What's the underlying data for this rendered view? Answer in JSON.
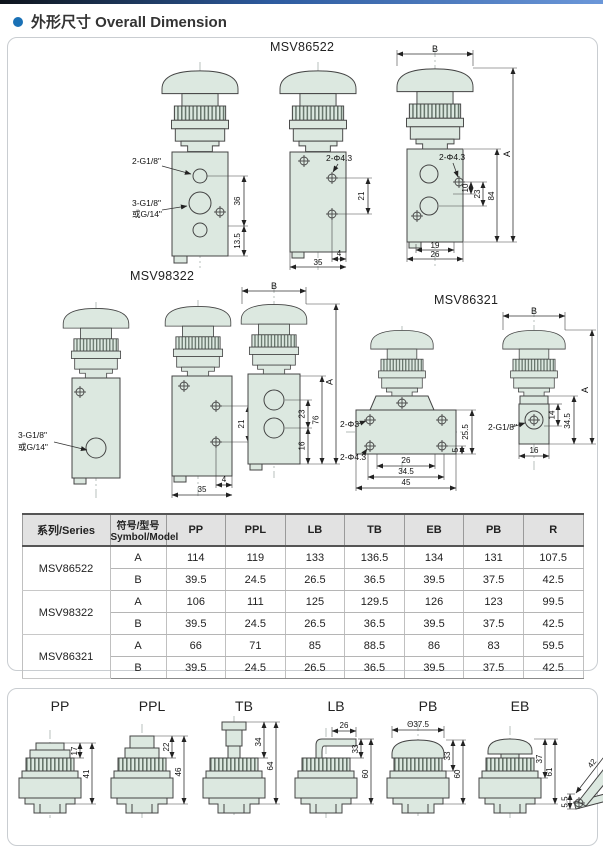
{
  "page": {
    "title": "外形尺寸 Overall Dimension"
  },
  "colors": {
    "accent": "#1a71b6",
    "drawing_fill": "#dce8e0",
    "table_header_bg": "#e2e2e2"
  },
  "drawings": {
    "m522": {
      "title": "MSV86522",
      "v1": {
        "port2": "2-G1/8\"",
        "port3": "3-G1/8\"",
        "port3b": "或G/14\"",
        "d36": "36",
        "d135": "13.5"
      },
      "v2": {
        "hole": "2-Φ4.3",
        "d21": "21",
        "d4": "4",
        "d35": "35"
      },
      "v3": {
        "b": "B",
        "a": "A",
        "hole": "2-Φ4.3",
        "d84": "84",
        "d23": "23",
        "d10": "10",
        "d19": "19",
        "d26": "26"
      }
    },
    "m983": {
      "title": "MSV98322",
      "v1": {
        "port3": "3-G1/8\"",
        "port3b": "或G/14\""
      },
      "v2": {
        "d21": "21",
        "d4": "4",
        "d35": "35"
      },
      "v3": {
        "b": "B",
        "d23": "23",
        "d16": "16",
        "d76": "76",
        "a": "A"
      }
    },
    "m863": {
      "title": "MSV86321",
      "v1": {
        "hole3": "2-Φ3",
        "hole43": "2-Φ4.3",
        "d255": "25.5",
        "d5": "5",
        "d26": "26",
        "d345": "34.5",
        "d45": "45"
      },
      "v2": {
        "b": "B",
        "a": "A",
        "d345": "34.5",
        "d14": "14",
        "d16": "16",
        "port": "2-G1/8\""
      }
    }
  },
  "table": {
    "headers": {
      "series": "系列/Series",
      "symbol_zh": "符号/型号",
      "symbol_en": "Symbol/Model",
      "cols": [
        "PP",
        "PPL",
        "LB",
        "TB",
        "EB",
        "PB",
        "R"
      ]
    },
    "groups": [
      {
        "series": "MSV86522",
        "rowA": {
          "model": "A",
          "v": [
            "114",
            "119",
            "133",
            "136.5",
            "134",
            "131",
            "107.5"
          ]
        },
        "rowB": {
          "model": "B",
          "v": [
            "39.5",
            "24.5",
            "26.5",
            "36.5",
            "39.5",
            "37.5",
            "42.5"
          ]
        }
      },
      {
        "series": "MSV98322",
        "rowA": {
          "model": "A",
          "v": [
            "106",
            "111",
            "125",
            "129.5",
            "126",
            "123",
            "99.5"
          ]
        },
        "rowB": {
          "model": "B",
          "v": [
            "39.5",
            "24.5",
            "26.5",
            "36.5",
            "39.5",
            "37.5",
            "42.5"
          ]
        }
      },
      {
        "series": "MSV86321",
        "rowA": {
          "model": "A",
          "v": [
            "66",
            "71",
            "85",
            "88.5",
            "86",
            "83",
            "59.5"
          ]
        },
        "rowB": {
          "model": "B",
          "v": [
            "39.5",
            "24.5",
            "26.5",
            "36.5",
            "39.5",
            "37.5",
            "42.5"
          ]
        }
      }
    ]
  },
  "buttons": [
    {
      "label": "PP",
      "d1": "17",
      "d2": "41"
    },
    {
      "label": "PPL",
      "d1": "22",
      "d2": "46"
    },
    {
      "label": "TB",
      "d1": "34",
      "d2": "64"
    },
    {
      "label": "LB",
      "d0": "26",
      "d1": "33",
      "d2": "60"
    },
    {
      "label": "PB",
      "d0": "Θ37.5",
      "d1": "33",
      "d2": "60"
    },
    {
      "label": "EB",
      "d1": "37",
      "d2": "61"
    },
    {
      "label": "R",
      "d0": "42",
      "d1": "34.5",
      "d2": "5.5"
    }
  ]
}
